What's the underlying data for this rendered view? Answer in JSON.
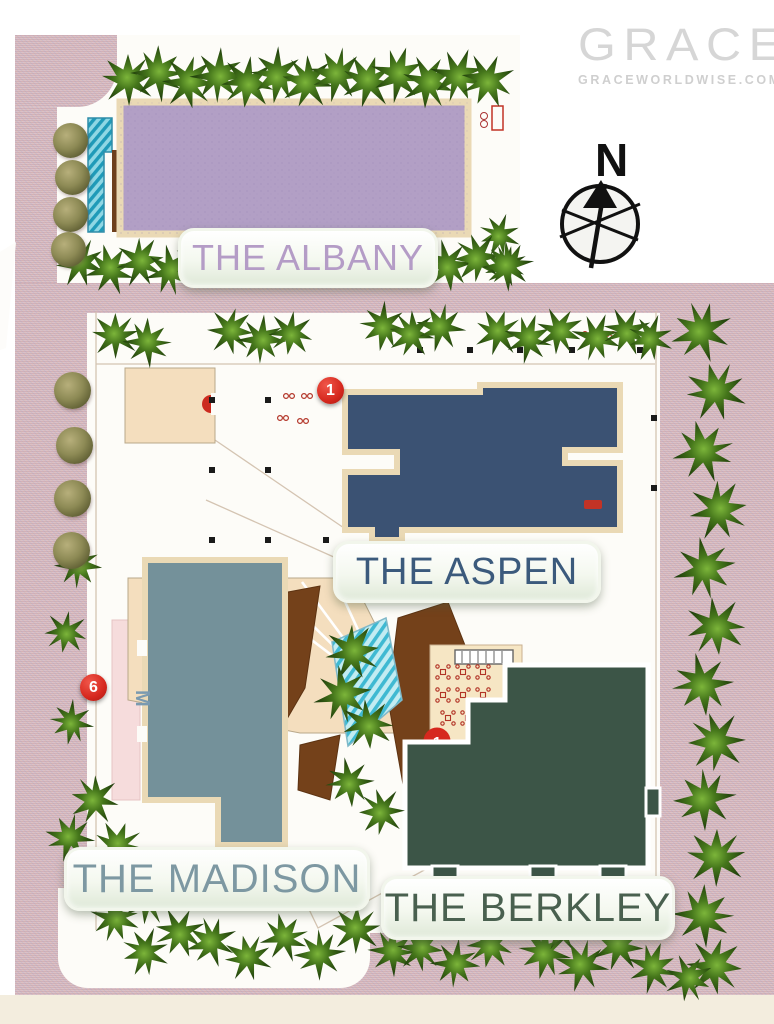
{
  "page": {
    "type": "residential-site-plan"
  },
  "logo": {
    "brand": "GRACE",
    "domain": "GRACEWORLDWISE.COM"
  },
  "compass": {
    "label": "N"
  },
  "buildings": [
    {
      "id": "albany",
      "label": "THE ALBANY",
      "fill": "#b29fc5",
      "label_color": "#b49cc6"
    },
    {
      "id": "aspen",
      "label": "THE ASPEN",
      "fill": "#3b5273",
      "label_color": "#3b5a7c"
    },
    {
      "id": "madison",
      "label": "THE MADISON",
      "fill": "#74919a",
      "label_color": "#7d98a2"
    },
    {
      "id": "berkley",
      "label": "THE BERKLEY",
      "fill": "#3c5547",
      "label_color": "#49604f"
    }
  ],
  "markers": [
    {
      "number": "1"
    },
    {
      "number": "6"
    },
    {
      "number": "1"
    }
  ],
  "annotations": {
    "side_letter": "M"
  },
  "colors": {
    "road": "#d2b0b8",
    "plot": "#fdfcf8",
    "pool": "#35b9d6",
    "tree_dark": "#234312",
    "label_plate": "#eef3e8",
    "marker_red": "#d6281e",
    "logo_gray": "#d6d6d6"
  }
}
